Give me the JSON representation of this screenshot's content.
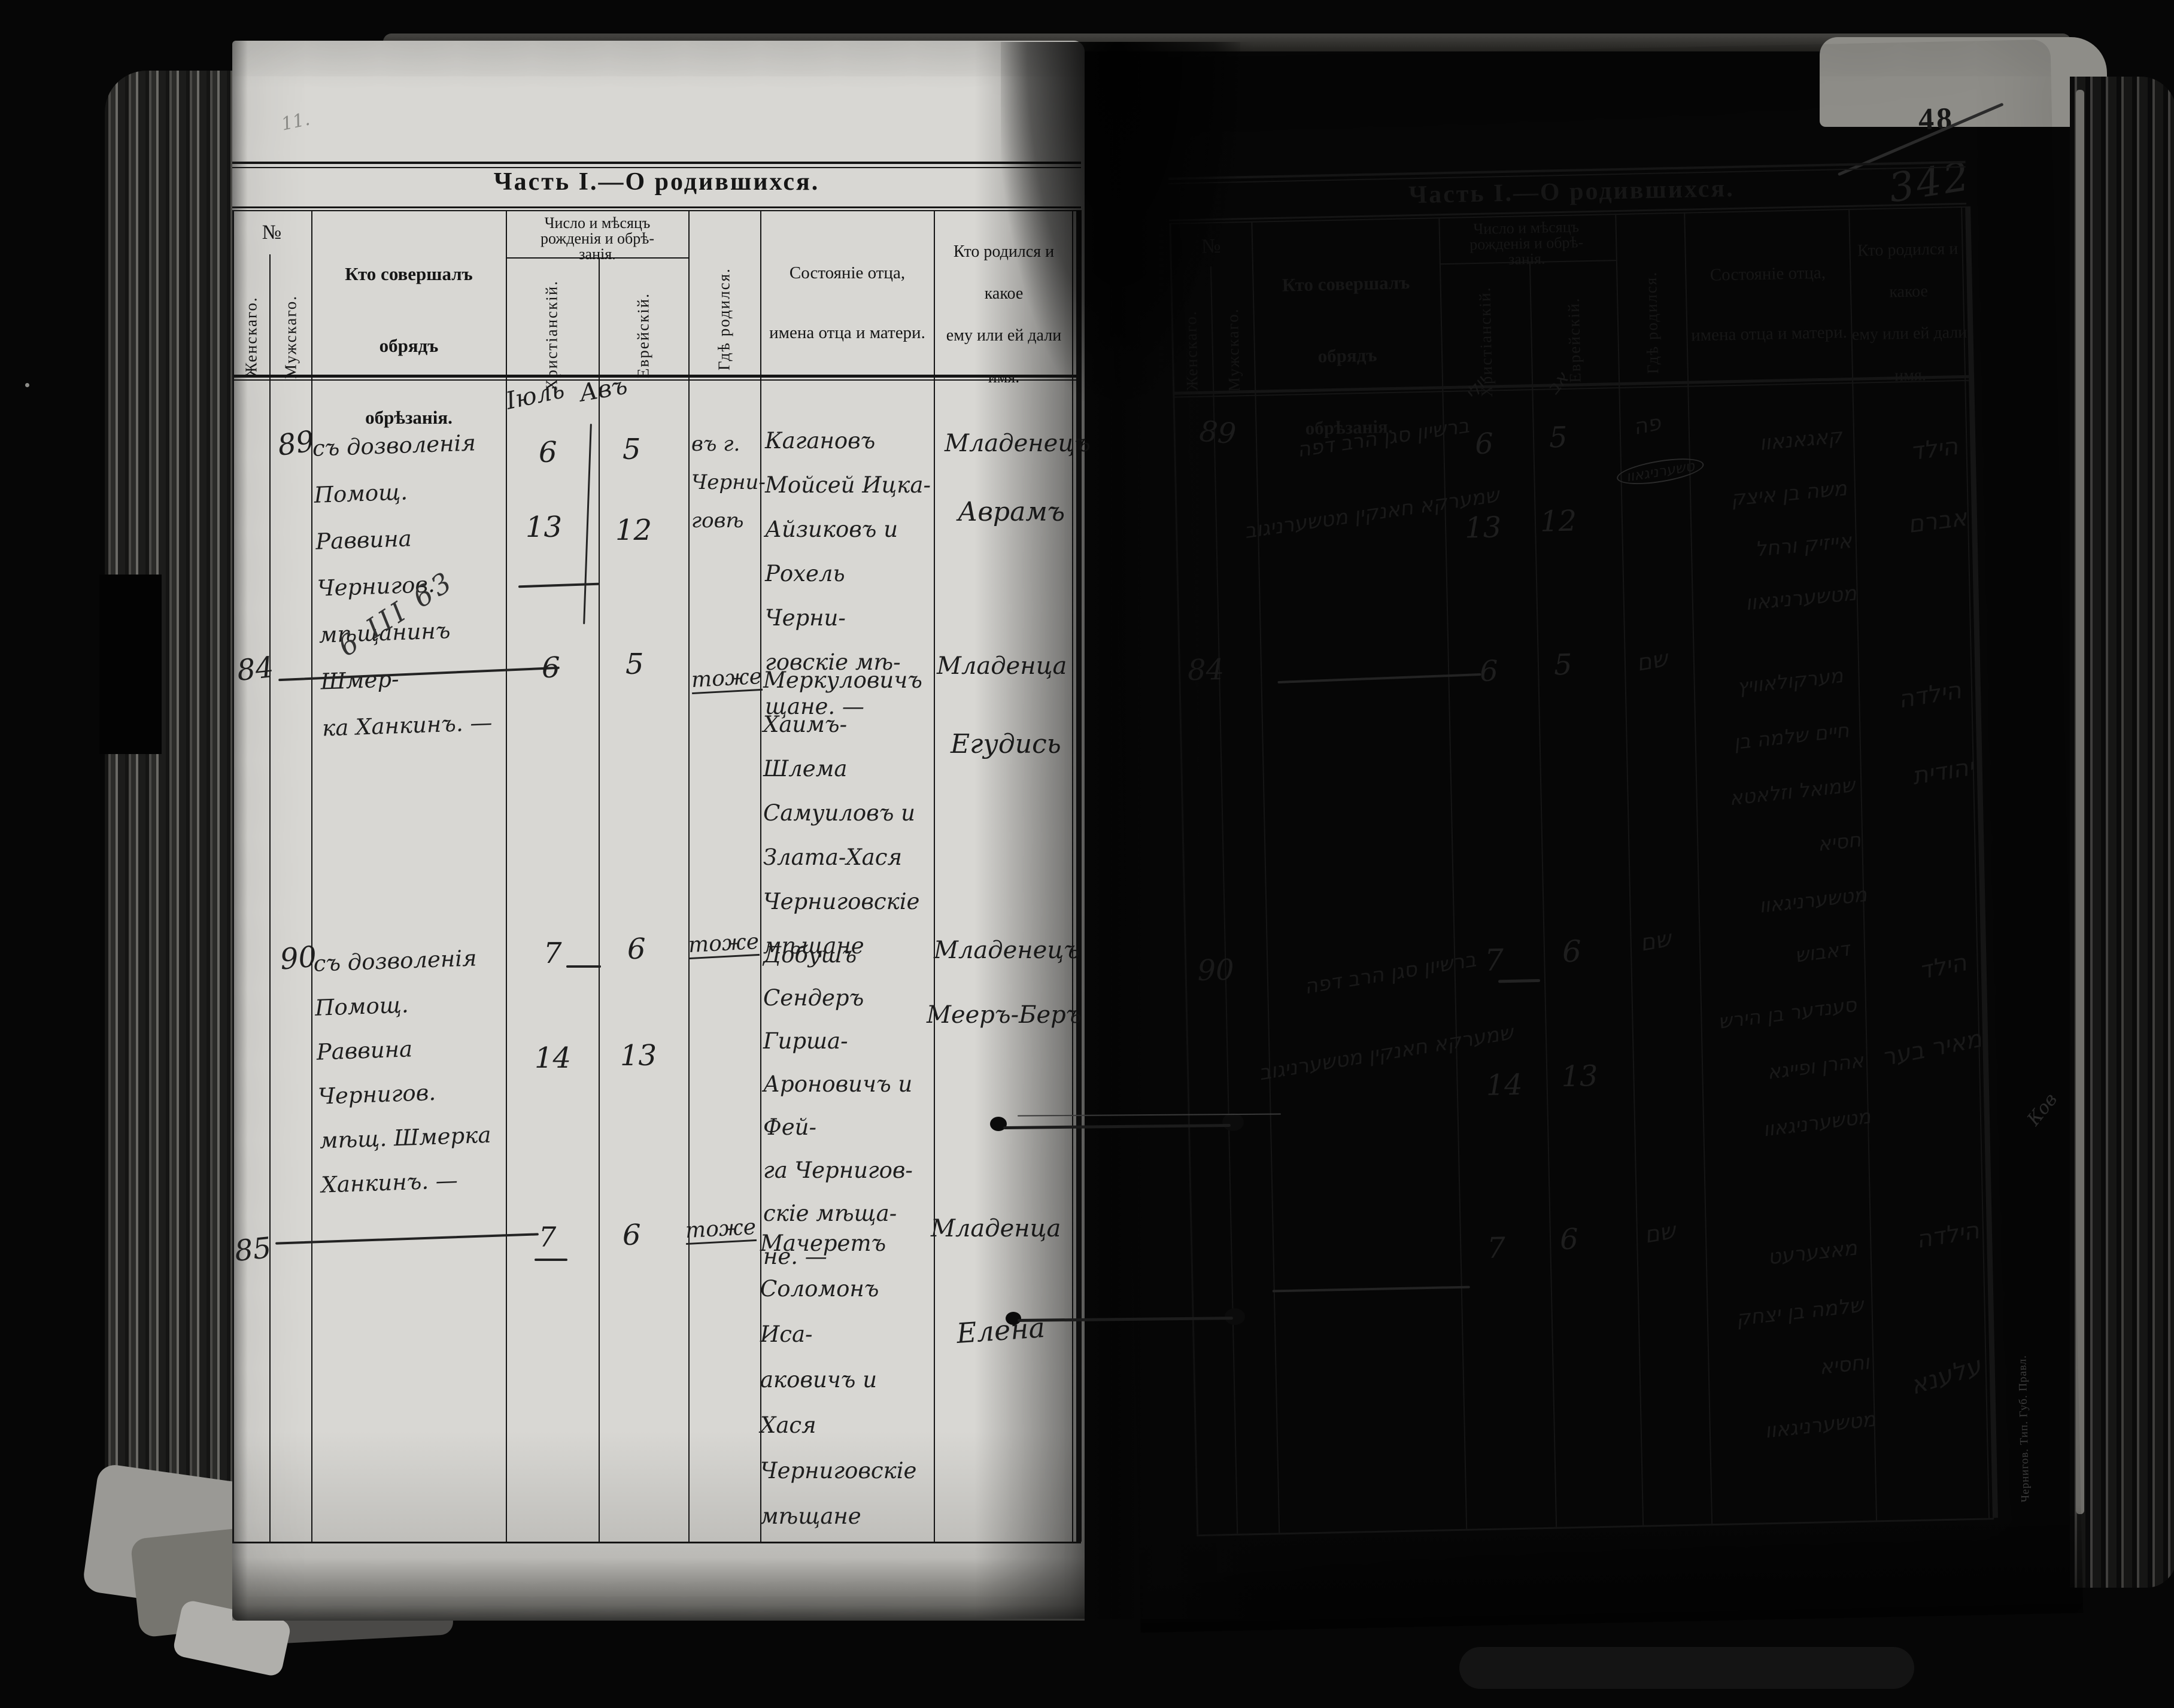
{
  "document": {
    "page_number_printed": "48",
    "page_number_handwritten": "342",
    "pencil_mark_top_left": "11.",
    "imprint_vertical": "Чернигов. Тип. Губ. Правл.",
    "margin_scribble": "Ков"
  },
  "form": {
    "title": "Часть I.—О родившихся.",
    "col_no": "№",
    "col_female": "Женскаго.",
    "col_male": "Мужскаго.",
    "col_officiant_lines": [
      "Кто совершалъ обрядъ",
      "обрѣзанія."
    ],
    "col_dates_lines": [
      "Число и мѣсяцъ",
      "рожденія и обрѣ-",
      "занія."
    ],
    "col_christian": "Христіанскій.",
    "col_hebrew": "Еврейскій.",
    "col_where": "Гдѣ родился.",
    "col_father_lines": [
      "Состояніе отца,",
      "имена отца и матери."
    ],
    "col_name_lines": [
      "Кто родился и какое",
      "ему или ей дали",
      "имя."
    ]
  },
  "left_page": {
    "month_christian": "Іюль",
    "month_hebrew": "Авъ",
    "entries": [
      {
        "no": "89",
        "officiant_lines": [
          "съ дозволенія Помощ.",
          "Раввина Чернигов.",
          "мѣщанинъ Шмер-",
          "ка Ханкинъ. —"
        ],
        "margin_note": "6 III 63",
        "birth_christian": "6",
        "birth_hebrew": "5",
        "circumcision_christian": "13",
        "circumcision_hebrew": "12",
        "where_lines": [
          "въ г.",
          "Черни-",
          "говѣ"
        ],
        "father_lines": [
          "Кагановъ",
          "Мойсей Ицка-",
          "Айзиковъ и",
          "Рохель Черни-",
          "говскіе мѣ-",
          "щане. —"
        ],
        "name_lines": [
          "Младенецъ",
          "Аврамъ"
        ]
      },
      {
        "no": "84",
        "officiant_mark": "—",
        "birth_christian": "6",
        "birth_hebrew": "5",
        "where_lines": [
          "тоже"
        ],
        "father_lines": [
          "Меркуловичъ",
          "Хаимъ-Шлема",
          "Самуиловъ и",
          "Злата-Хася",
          "Черниговскіе",
          "мѣщане"
        ],
        "name_lines": [
          "Младенца",
          "Егудись"
        ]
      },
      {
        "no": "90",
        "officiant_lines": [
          "съ дозволенія Помощ.",
          "Раввина Чернигов.",
          "мѣщ. Шмерка",
          "Ханкинъ. —"
        ],
        "birth_christian": "7",
        "birth_hebrew": "6",
        "circumcision_christian": "14",
        "circumcision_hebrew": "13",
        "where_lines": [
          "тоже"
        ],
        "father_lines": [
          "Добушъ",
          "Сендеръ Гирша-",
          "Ароновичъ и Фей-",
          "га Чернигов-",
          "скіе мѣща-",
          "не. —"
        ],
        "name_lines": [
          "Младенецъ",
          "Мееръ-Беръ"
        ]
      },
      {
        "no": "85",
        "officiant_mark": "—",
        "birth_christian": "7",
        "birth_hebrew": "6",
        "where_lines": [
          "тоже"
        ],
        "father_lines": [
          "Мачеретъ",
          "Соломонъ Иса-",
          "аковичъ и Хася",
          "Черниговскіе",
          "мѣщане"
        ],
        "name_lines": [
          "Младенца",
          "Елена"
        ]
      }
    ]
  },
  "right_page": {
    "month_christian": "יולי",
    "month_hebrew": "אב",
    "entries": [
      {
        "no": "89",
        "officiant_lines": [
          "ברשיון סגן הרב דפה",
          "שמערקא חאנקין מטשערניגוב"
        ],
        "birth_christian": "6",
        "birth_hebrew": "5",
        "circumcision_christian": "13",
        "circumcision_hebrew": "12",
        "where_lines": [
          "פה",
          "טשערניגאוו"
        ],
        "father_lines": [
          "קאגאנאוו",
          "משה בן איצק",
          "אייזיק ורחל",
          "מטשערניגאוו"
        ],
        "name_lines": [
          "הילד",
          "אברם"
        ]
      },
      {
        "no": "84",
        "officiant_mark": "—",
        "birth_christian": "6",
        "birth_hebrew": "5",
        "where_lines": [
          "שם"
        ],
        "father_lines": [
          "מערקולאוויץ",
          "חיים שלמה בן",
          "שמואל וזלאטא",
          "חסיא מטשערניגאוו"
        ],
        "name_lines": [
          "הילדה",
          "יהודית"
        ]
      },
      {
        "no": "90",
        "officiant_lines": [
          "ברשיון סגן הרב דפה",
          "שמערקא חאנקין מטשערניגוב"
        ],
        "birth_christian": "7",
        "birth_hebrew": "6",
        "circumcision_christian": "14",
        "circumcision_hebrew": "13",
        "where_lines": [
          "שם"
        ],
        "father_lines": [
          "דאבוש",
          "סענדער בן הירש",
          "אהרן ופייגא",
          "מטשערניגאוו"
        ],
        "name_lines": [
          "הילד",
          "מאיר בער"
        ]
      },
      {
        "no": "85",
        "officiant_mark": "—",
        "birth_christian": "7",
        "birth_hebrew": "6",
        "where_lines": [
          "שם"
        ],
        "father_lines": [
          "מאצערעט",
          "שלמה בן יצחק",
          "וחסיא",
          "מטשערניגאוו"
        ],
        "name_lines": [
          "הילדה",
          "עלענא"
        ]
      }
    ]
  },
  "colors": {
    "paper": "#d8d7d3",
    "ink": "#1d1d1d",
    "background": "#060606"
  }
}
